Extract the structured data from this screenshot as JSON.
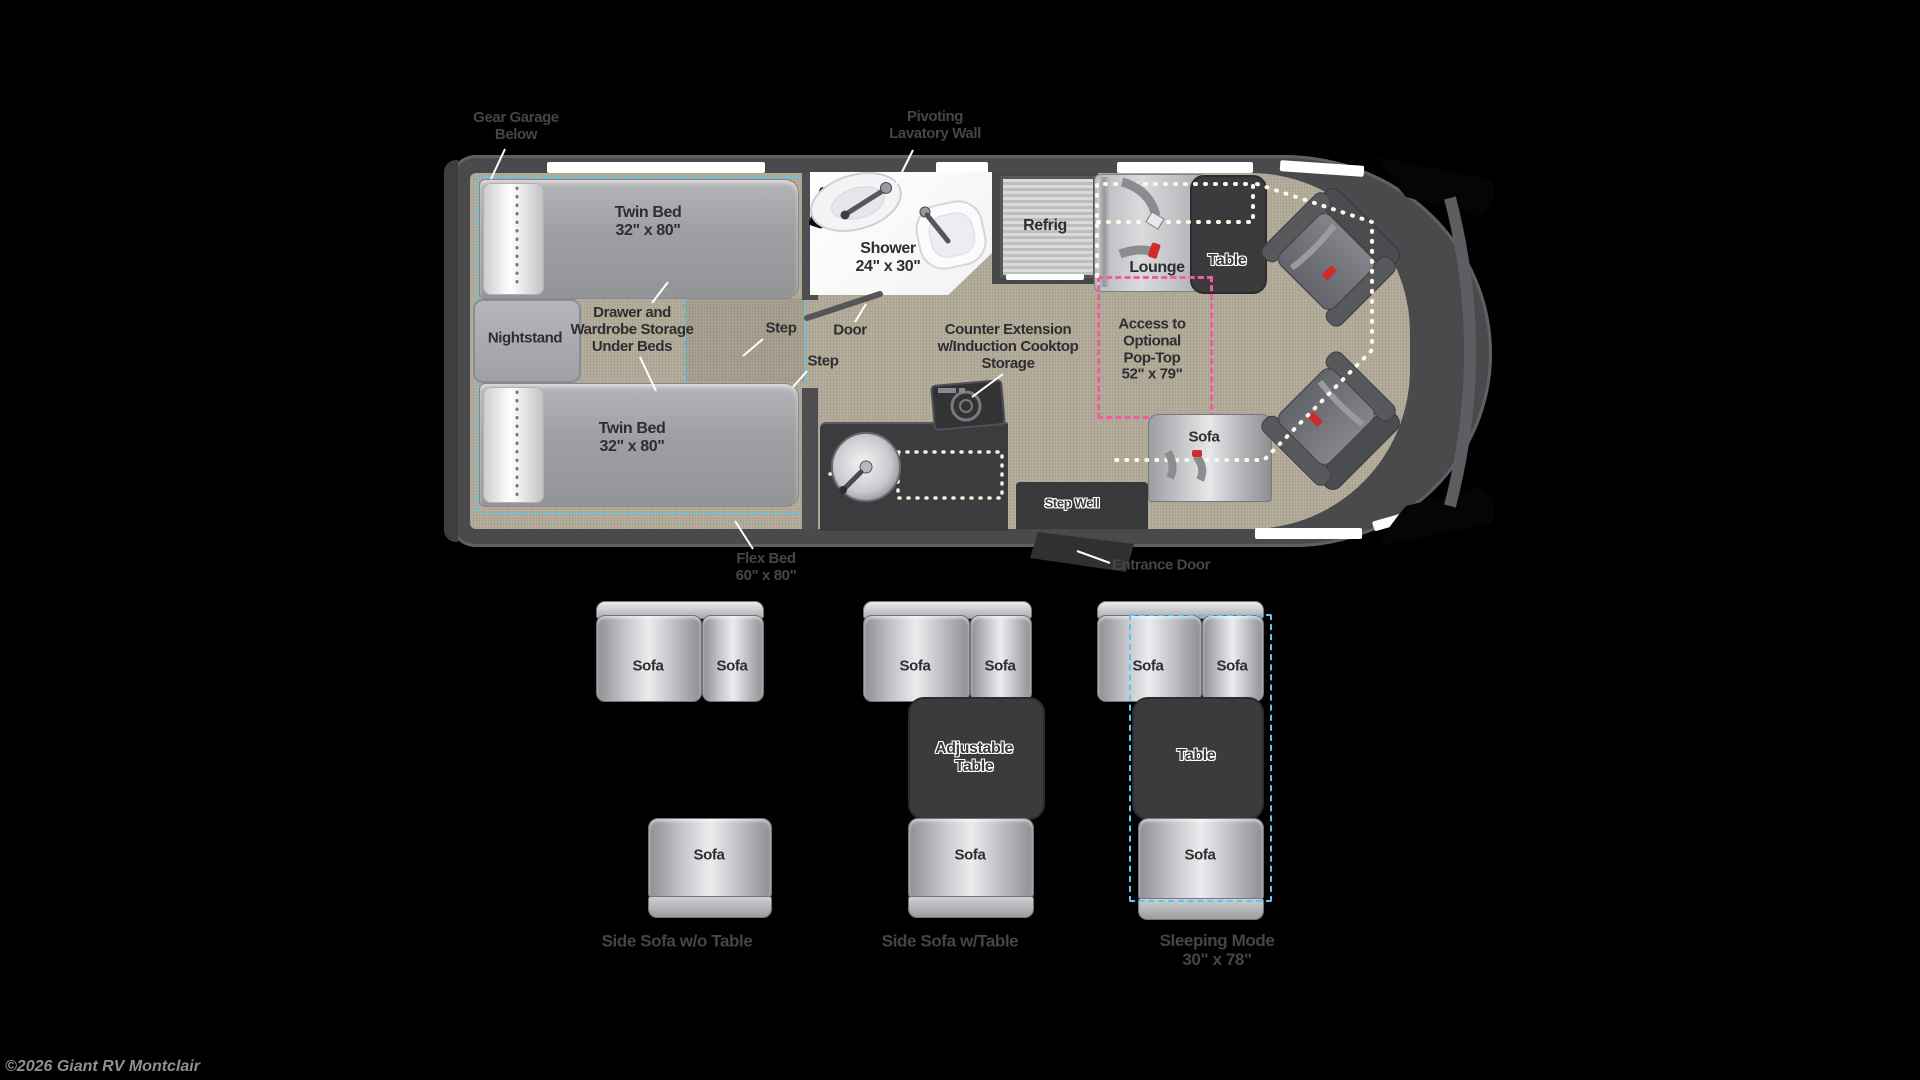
{
  "colors": {
    "background": "#000000",
    "rv_body": "#4a4a4d",
    "floor_tan": "#b2aa99",
    "flex_zone_blue": "#64c3ea",
    "poptop_pink": "#ee5f9d",
    "dark_furniture": "#3b3b3e",
    "metal_light": "#e6e7e9",
    "seatbelt_red": "#cf2b2b"
  },
  "floorplan": {
    "gear_garage_l1": "Gear Garage",
    "gear_garage_l2": "Below",
    "pivot_l1": "Pivoting",
    "pivot_l2": "Lavatory Wall",
    "twin_bed_l1": "Twin Bed",
    "twin_bed_l2": "32\" x 80\"",
    "nightstand": "Nightstand",
    "storage_l1": "Drawer and",
    "storage_l2": "Wardrobe Storage",
    "storage_l3": "Under Beds",
    "step": "Step",
    "door": "Door",
    "shower_l1": "Shower",
    "shower_l2": "24\" x 30\"",
    "refrig": "Refrig",
    "counter_l1": "Counter Extension",
    "counter_l2": "w/Induction Cooktop",
    "counter_l3": "Storage",
    "poptop_l1": "Access to",
    "poptop_l2": "Optional",
    "poptop_l3": "Pop-Top",
    "poptop_l4": "52\" x 79\"",
    "lounge": "Lounge",
    "table": "Table",
    "sofa": "Sofa",
    "step_well": "Step Well",
    "entrance_door": "Entrance Door",
    "flex_l1": "Flex Bed",
    "flex_l2": "60\" x 80\""
  },
  "configs": {
    "sofa": "Sofa",
    "c1_title": "Side Sofa w/o Table",
    "c2_title": "Side Sofa w/Table",
    "c2_table_l1": "Adjustable",
    "c2_table_l2": "Table",
    "c3_table": "Table",
    "c3_title_l1": "Sleeping Mode",
    "c3_title_l2": "30\" x 78\""
  },
  "footer": {
    "copyright": "©2026 Giant RV Montclair"
  }
}
